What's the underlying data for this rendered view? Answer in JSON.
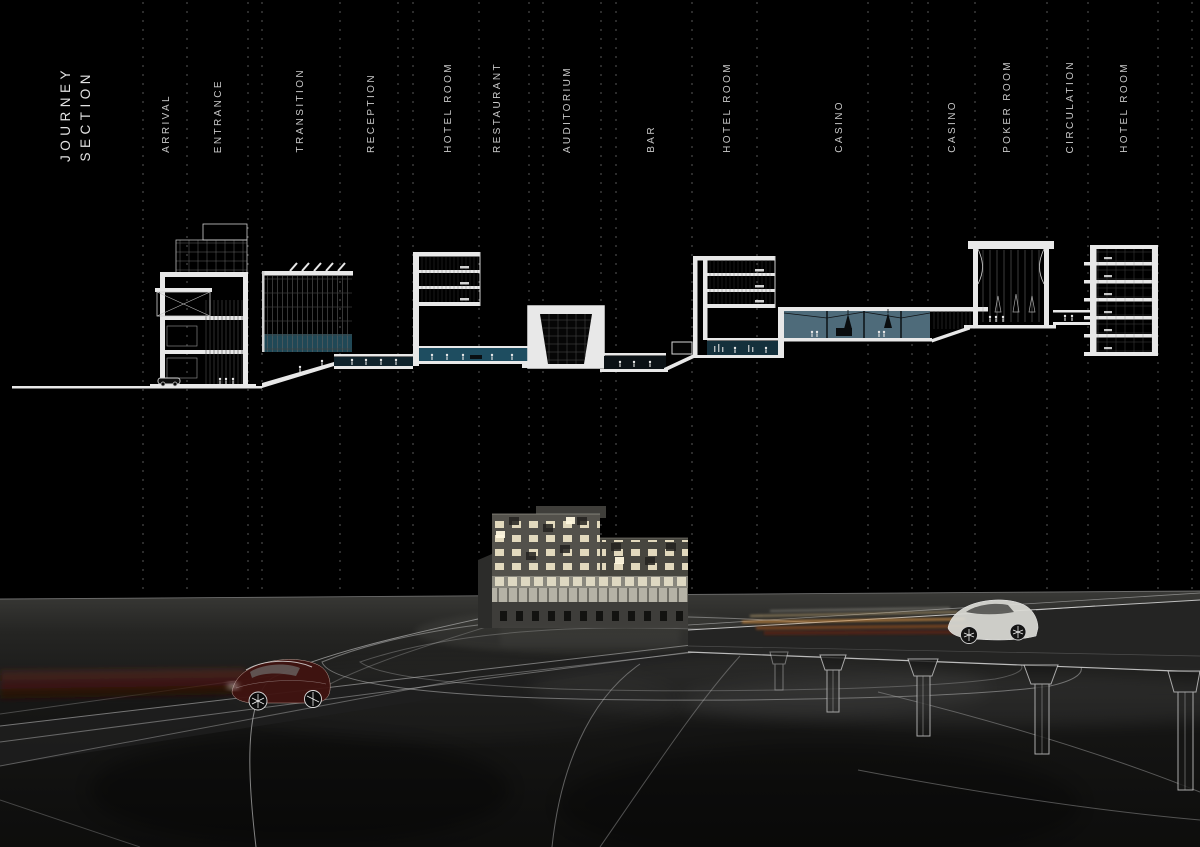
{
  "title": {
    "line1": "JOURNEY",
    "line2": "SECTION"
  },
  "section_labels": [
    "ARRIVAL",
    "ENTRANCE",
    "TRANSITION",
    "RECEPTION",
    "HOTEL ROOM",
    "RESTAURANT",
    "AUDITORIUM",
    "BAR",
    "HOTEL ROOM",
    "CASINO",
    "CASINO",
    "POKER ROOM",
    "CIRCULATION",
    "HOTEL ROOM"
  ],
  "palette": {
    "background": "#000000",
    "section_linework": "#e8e8e8",
    "dashed_gridline": "#6f6f6f",
    "glass_teal": "#4e6b7a",
    "restaurant_teal": "#1e4d60",
    "bar_teal": "#14303c",
    "render_window_lit": "#efe6c8",
    "ground_gray": "#171716",
    "trail_orange": "#c98a43",
    "trail_dark_red": "#4a120c"
  }
}
